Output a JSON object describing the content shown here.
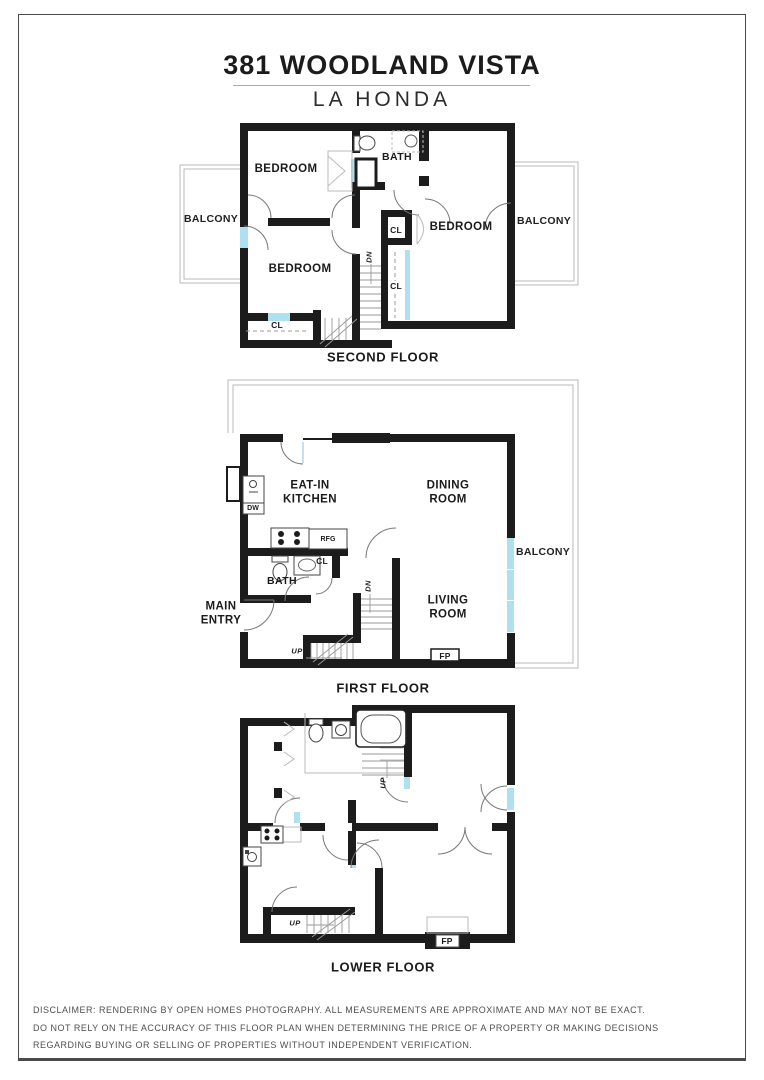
{
  "header": {
    "title": "381 WOODLAND VISTA",
    "subtitle": "LA HONDA"
  },
  "floors": {
    "second": {
      "name": "SECOND FLOOR",
      "rooms": {
        "bedroom_top_left": "BEDROOM",
        "bath": "BATH",
        "bedroom_right": "BEDROOM",
        "bedroom_bottom_left": "BEDROOM",
        "balcony_left": "BALCONY",
        "balcony_right": "BALCONY",
        "closet_top": "CL",
        "closet_tall": "CL",
        "closet_bottom": "CL",
        "stairs_dn": "DN"
      }
    },
    "first": {
      "name": "FIRST FLOOR",
      "rooms": {
        "eat_in_kitchen": "EAT-IN KITCHEN",
        "dining_room": "DINING ROOM",
        "living_room": "LIVING ROOM",
        "balcony": "BALCONY",
        "bath": "BATH",
        "main_entry": "MAIN ENTRY",
        "closet": "CL",
        "dishwasher": "DW",
        "refrigerator": "RFG",
        "fireplace": "FP",
        "stairs_dn": "DN",
        "stairs_up": "UP"
      }
    },
    "lower": {
      "name": "LOWER FLOOR",
      "rooms": {
        "stairs_up_upper": "UP",
        "stairs_up_lower": "UP",
        "fireplace": "FP"
      }
    }
  },
  "disclaimer": {
    "line1": "DISCLAIMER: RENDERING BY OPEN HOMES PHOTOGRAPHY. ALL MEASUREMENTS ARE APPROXIMATE AND MAY NOT BE EXACT.",
    "line2": "DO NOT RELY ON THE ACCURACY OF THIS FLOOR PLAN WHEN DETERMINING THE PRICE OF A PROPERTY OR MAKING DECISIONS",
    "line3": "REGARDING BUYING OR SELLING OF PROPERTIES WITHOUT INDEPENDENT VERIFICATION."
  },
  "colors": {
    "wall": "#1c1c1c",
    "window": "#aee0f2",
    "deck_outline": "#b9b9b9"
  }
}
